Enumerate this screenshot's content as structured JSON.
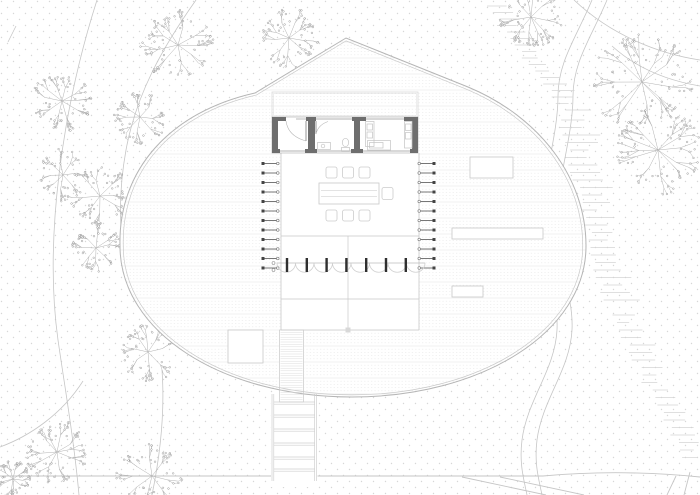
{
  "drawing": {
    "type": "architectural-site-plan",
    "canvas_w": 700,
    "canvas_h": 495,
    "background": "#ffffff"
  },
  "palette": {
    "dot": "#d7d7d7",
    "contour": "#c6c6c6",
    "grass": "#d5d5d5",
    "tree_branch": "#b2b2b2",
    "tree_dot": "#9a9a9a",
    "plaza_outline": "#b5b5b5",
    "plaza_outline_inner": "#c9c9c9",
    "texture_solid": "#e2e2e2",
    "texture_dash": "#e9e9e9",
    "thin": "#c8c8c8",
    "thin_light": "#d9d9d9",
    "wall": "#6e6e6e",
    "fixture": "#c4c4c4",
    "post": "#2f2f2f",
    "tick": "#555555",
    "white": "#ffffff"
  },
  "background_dots": {
    "tile": 12,
    "r": 0.7,
    "offsets": [
      [
        1.5,
        1.5
      ],
      [
        7.5,
        7.5
      ]
    ]
  },
  "contours": [
    "M 97 0 C 62 110 44 240 58 340 C 64 382 74 440 79 495",
    "M 196 0 C 162 48 136 95 126 150 C 120 183 119 212 122 242",
    "M 83 381 C 62 414 30 436 0 447",
    "M 162 370 C 165 412 160 456 152 495",
    "M 592 0 C 576 38 558 62 558 96 C 558 132 545 172 541 214 C 537 258 559 290 557 330 C 555 370 527 400 522 440 C 519 464 524 480 527 495",
    "M 607 0 C 591 38 573 62 573 96 C 573 132 560 172 556 214 C 552 258 574 290 572 330 C 570 370 542 400 537 440 C 534 464 539 480 542 495",
    "M 574 0 C 612 36 660 54 700 60",
    "M 700 86 C 664 80 634 66 612 46",
    "M 8 42 L 16 26"
  ],
  "ground_paths": [
    "M 0 476 L 543 476",
    "M 543 476 C 598 471 650 472 700 477",
    "M 462 477 L 546 495",
    "M 500 477 L 584 495",
    "M 676 476 L 667 495",
    "M 690 472 L 684 495"
  ],
  "grass_bands": [
    {
      "x0": 487,
      "y0": 6,
      "x1": 563,
      "y1": 112,
      "step": 6.5,
      "wmin": 12,
      "wmax": 26,
      "seed": 11
    },
    {
      "x0": 560,
      "y0": 120,
      "x1": 606,
      "y1": 305,
      "step": 7.5,
      "wmin": 18,
      "wmax": 40,
      "seed": 22
    },
    {
      "x0": 612,
      "y0": 315,
      "x1": 683,
      "y1": 462,
      "step": 7.5,
      "wmin": 12,
      "wmax": 26,
      "seed": 33
    }
  ],
  "trees": [
    {
      "cx": 178,
      "cy": 45,
      "r": 30,
      "seed": 1
    },
    {
      "cx": 289,
      "cy": 38,
      "r": 26,
      "seed": 2
    },
    {
      "cx": 62,
      "cy": 101,
      "r": 26,
      "seed": 3
    },
    {
      "cx": 140,
      "cy": 117,
      "r": 23,
      "seed": 4
    },
    {
      "cx": 63,
      "cy": 175,
      "r": 22,
      "seed": 5
    },
    {
      "cx": 100,
      "cy": 196,
      "r": 26,
      "seed": 6
    },
    {
      "cx": 96,
      "cy": 248,
      "r": 21,
      "seed": 7
    },
    {
      "cx": 148,
      "cy": 352,
      "r": 26,
      "seed": 8
    },
    {
      "cx": 57,
      "cy": 452,
      "r": 27,
      "seed": 9
    },
    {
      "cx": 152,
      "cy": 476,
      "r": 29,
      "seed": 10
    },
    {
      "cx": 13,
      "cy": 479,
      "r": 16,
      "seed": 11
    },
    {
      "cx": 531,
      "cy": 17,
      "r": 28,
      "seed": 12
    },
    {
      "cx": 642,
      "cy": 82,
      "r": 44,
      "seed": 13
    },
    {
      "cx": 658,
      "cy": 150,
      "r": 38,
      "seed": 14
    }
  ],
  "plaza": {
    "outline": "M 120 246 C 118 170 170 112 255 93 L 346 38 L 468 87 C 540 117 586 178 586 246 C 586 332 482 397 352 397 C 222 397 120 332 120 246 Z",
    "cx": 353,
    "cy": 243,
    "scale_inner": 0.986,
    "texture": {
      "x0": 116,
      "x1": 590,
      "y0": 42,
      "y1": 396,
      "step": 3.2,
      "solid_every": 5
    }
  },
  "roof": {
    "x": 272,
    "y": 92,
    "w": 146,
    "h": 25
  },
  "terrace": {
    "white": [
      281,
      153,
      138,
      177
    ],
    "left_x": 281,
    "right_x": 419,
    "top_y": 153,
    "mid_y": 236,
    "deck_line_y": 299,
    "bottom_y": 330,
    "center_x": 348,
    "center_top": 236,
    "marker": [
      345.5,
      327.5,
      5,
      5
    ]
  },
  "ticks": {
    "y0": 163.5,
    "step": 9.5,
    "n": 12,
    "left": {
      "x1": 263,
      "x2": 277,
      "sq_x": 261.5,
      "circ_x": 277.8
    },
    "right": {
      "x1": 420,
      "x2": 434,
      "sq_x": 432.5,
      "circ_x": 419.2
    }
  },
  "canopy": {
    "line_y": 263,
    "x0": 277,
    "x1": 425,
    "arc_n": 8,
    "arc_r": 9.25,
    "posts_x0": 287,
    "posts_step": 19.8,
    "posts_n": 7,
    "post_y": 258,
    "post_h": 14,
    "end_circles": [
      [
        273.5,
        263
      ],
      [
        273.5,
        270
      ]
    ]
  },
  "ramp": {
    "x": 279.5,
    "y": 330,
    "w": 24,
    "h": 72,
    "tex_step": 2.4
  },
  "stairs": {
    "x0": 272,
    "x1": 316.5,
    "rail_gap": 1.8,
    "y0": 394,
    "y1": 481,
    "steps_y": [
      402,
      415,
      429,
      443,
      457,
      469
    ],
    "step_gap": 2.2
  },
  "benches": [
    [
      470,
      157,
      43,
      21
    ],
    [
      452,
      228,
      91,
      11
    ],
    [
      452,
      286,
      31,
      11
    ]
  ],
  "planter": [
    228,
    330,
    35,
    33
  ],
  "furniture": {
    "table": [
      319,
      183,
      60,
      21
    ],
    "table_inner_y": [
      190.5,
      196.5
    ],
    "table_inner_x": [
      321,
      377
    ],
    "chairs": [
      [
        326,
        167,
        11,
        11
      ],
      [
        342.5,
        167,
        11,
        11
      ],
      [
        359,
        167,
        11,
        11
      ],
      [
        326,
        210,
        11,
        11
      ],
      [
        342.5,
        210,
        11,
        11
      ],
      [
        359,
        210,
        11,
        11
      ],
      [
        382,
        187.5,
        11,
        12
      ]
    ]
  },
  "building": {
    "outline": [
      272,
      117,
      146,
      36
    ],
    "walls": [
      [
        272,
        117,
        6,
        36
      ],
      [
        412,
        117,
        6,
        36
      ],
      [
        272,
        117,
        14,
        4
      ],
      [
        306,
        117,
        10,
        4
      ],
      [
        352,
        117,
        14,
        4
      ],
      [
        404,
        117,
        14,
        4
      ],
      [
        272,
        149,
        8,
        4
      ],
      [
        305,
        149,
        12,
        4
      ],
      [
        351,
        149,
        12,
        4
      ],
      [
        410,
        149,
        8,
        4
      ],
      [
        308,
        121,
        7,
        28
      ],
      [
        354,
        121,
        6,
        28
      ]
    ],
    "glazing": [
      [
        296,
        119,
        306,
        119
      ],
      [
        316,
        119,
        352,
        119
      ],
      [
        366,
        119,
        404,
        119
      ],
      [
        280,
        151,
        305,
        151
      ],
      [
        315,
        151,
        351,
        151
      ],
      [
        360,
        151,
        410,
        151
      ]
    ],
    "door_leaves": [
      [
        306,
        121,
        306,
        141
      ],
      [
        316,
        121,
        316,
        134
      ]
    ],
    "door_arcs": [
      "M 286 121 Q 288 136 306 141",
      "M 316 134 Q 318 125 328 121.5"
    ],
    "fixtures": {
      "sink": [
        317.5,
        142.5,
        13,
        7
      ],
      "faucet": [
        323,
        146,
        1.8
      ],
      "toilet_bowl": [
        345.5,
        142.5,
        3.2,
        4.2
      ],
      "toilet_tank": [
        341.5,
        147.5,
        8,
        4
      ],
      "tall_unit": [
        365.5,
        121.5,
        8.5,
        25
      ],
      "tall_unit_squares": [
        [
          367,
          124,
          5.5,
          6
        ],
        [
          367,
          132,
          5.5,
          6
        ]
      ],
      "counter": [
        367.5,
        140.5,
        23,
        9.5
      ],
      "counter_inner": [
        369.5,
        142.5,
        13.5,
        5.5
      ],
      "cabinet": [
        404.5,
        121.5,
        7.5,
        26.5
      ],
      "cabinet_squares": [
        [
          405.5,
          124,
          5.5,
          6.5
        ],
        [
          405.5,
          132.5,
          5.5,
          6.5
        ]
      ]
    }
  }
}
